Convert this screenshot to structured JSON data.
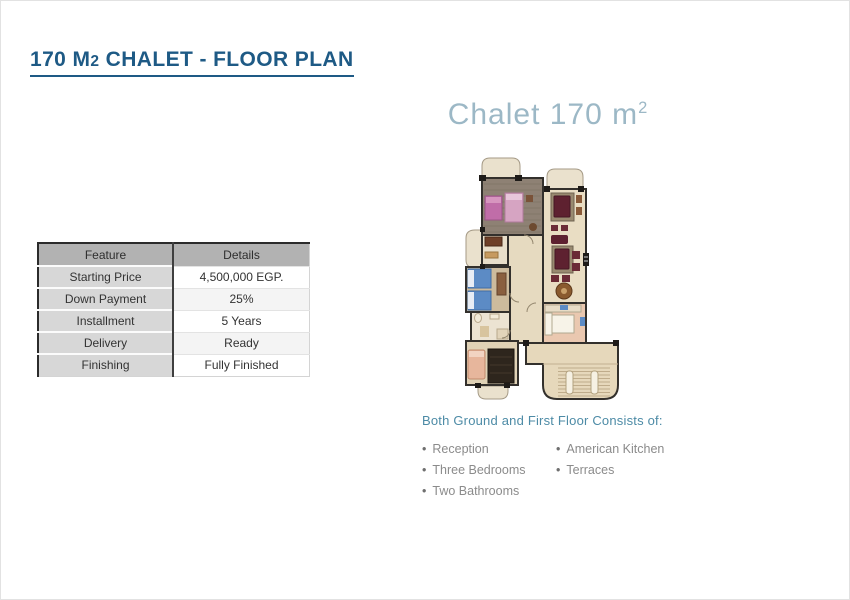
{
  "header": {
    "title_pre": "170 M",
    "title_sub": "2",
    "title_post": " CHALET - FLOOR PLAN"
  },
  "plan": {
    "heading_pre": "Chalet 170 m",
    "heading_sup": "2"
  },
  "table": {
    "headers": [
      "Feature",
      "Details"
    ],
    "rows": [
      {
        "feature": "Starting Price",
        "details": "4,500,000 EGP."
      },
      {
        "feature": "Down Payment",
        "details": "25%"
      },
      {
        "feature": "Installment",
        "details": "5 Years"
      },
      {
        "feature": "Delivery",
        "details": "Ready"
      },
      {
        "feature": "Finishing",
        "details": "Fully Finished"
      }
    ]
  },
  "consists": {
    "heading": "Both Ground and First Floor Consists of:",
    "bullet": "•",
    "col1": [
      "Reception",
      "Three Bedrooms",
      "Two Bathrooms"
    ],
    "col2": [
      "American Kitchen",
      "Terraces"
    ]
  },
  "colors": {
    "title": "#1e5a85",
    "plan_heading": "#9cb8c6",
    "consists_heading": "#4d8ba6",
    "bullet_text": "#8b8b8b",
    "table_header_bg": "#b2b2b2",
    "table_feature_bg": "#d7d7d7"
  }
}
